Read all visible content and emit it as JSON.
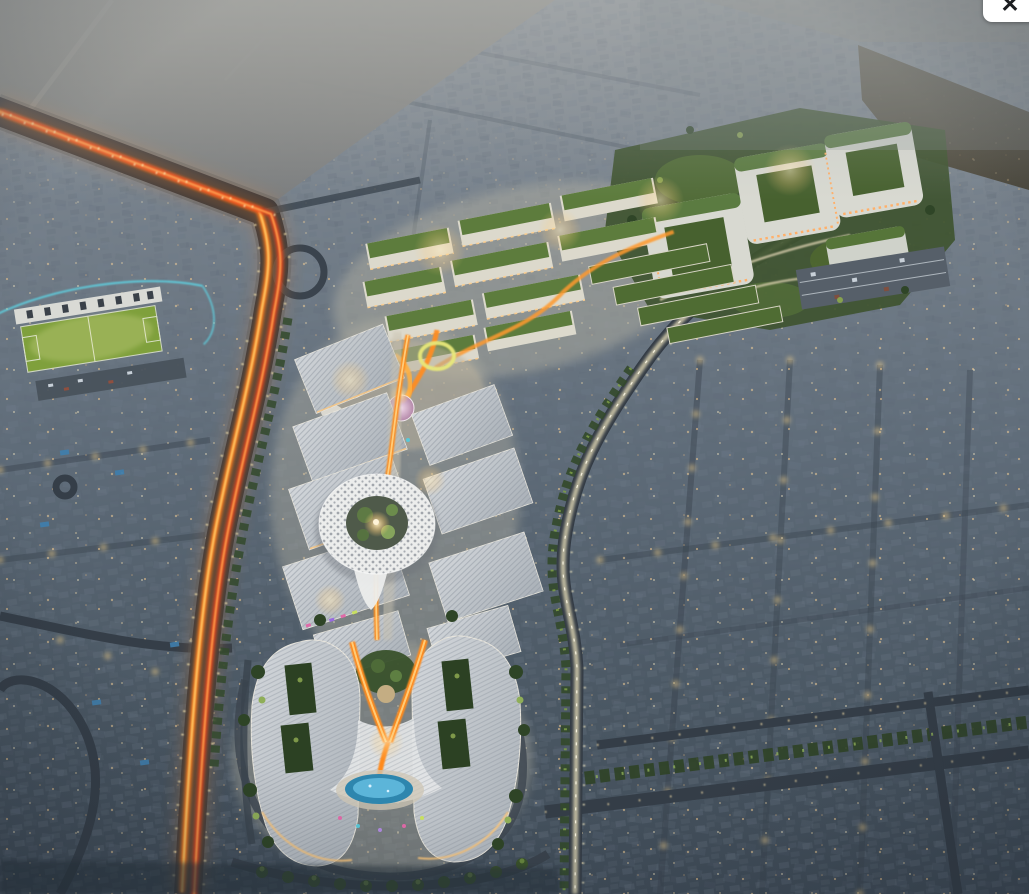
{
  "viewer": {
    "close_label": "✕",
    "close_icon": "close-icon"
  },
  "scene": {
    "alt": "Dusk aerial rendering of a lit mixed-use development with a white lattice-ring landmark, retail village with green roofs, residential cluster, stadium pitch and glowing arterial roads amid suburban villas",
    "colors": {
      "dusk_base": "#5f6c79",
      "haze": "#b3b6b6",
      "desert": "#8d8c85",
      "vacant_plot_brown": "#544f40",
      "road_dark": "#323a44",
      "light_trail_orange": "#ff7d1c",
      "light_trail_red": "#e8441c",
      "lit_road": "#ded6b4",
      "warm_light": "#ffd08a",
      "mall_roof": "#c6cbd1",
      "green_roof": "#5a7c3e",
      "landscape_green": "#3f5430",
      "pitch_green": "#7fa03c",
      "track_teal": "#5ecfdf",
      "lattice_white": "#ecedec",
      "pool_blue": "#2e86ae",
      "storefront_pink": "#e06aa8",
      "dome_pink": "#c08fb0"
    }
  }
}
